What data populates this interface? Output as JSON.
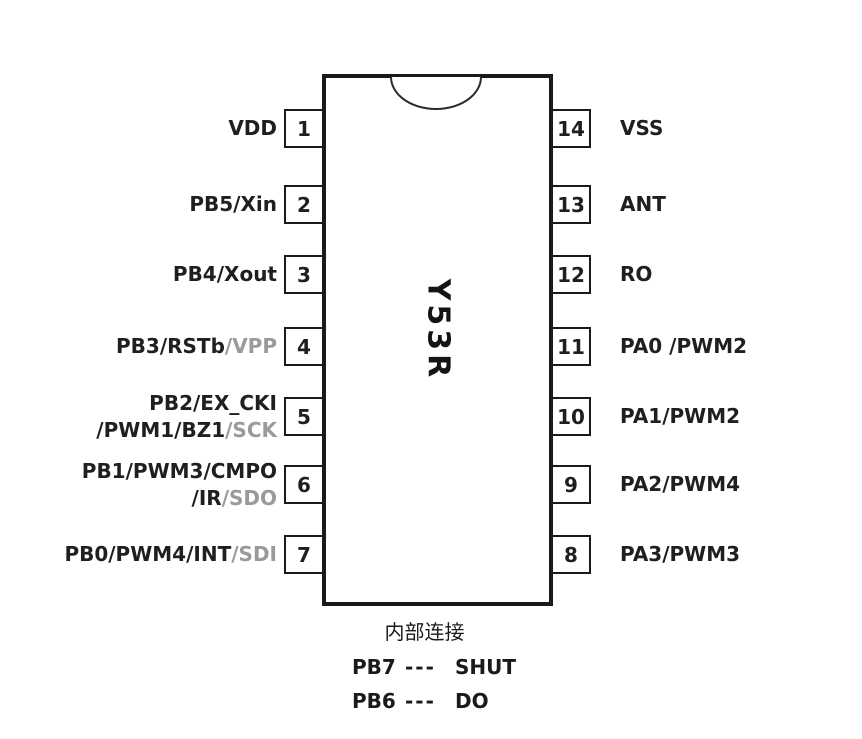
{
  "diagram": {
    "chip_name": "Y53R",
    "left_pins": [
      {
        "number": "1",
        "lines": [
          [
            {
              "text": "VDD",
              "gray": false
            }
          ]
        ]
      },
      {
        "number": "2",
        "lines": [
          [
            {
              "text": "PB5/Xin",
              "gray": false
            }
          ]
        ]
      },
      {
        "number": "3",
        "lines": [
          [
            {
              "text": "PB4/Xout",
              "gray": false
            }
          ]
        ]
      },
      {
        "number": "4",
        "lines": [
          [
            {
              "text": "PB3/RSTb",
              "gray": false
            },
            {
              "text": "/VPP",
              "gray": true
            }
          ]
        ]
      },
      {
        "number": "5",
        "lines": [
          [
            {
              "text": "PB2/EX_CKI",
              "gray": false
            }
          ],
          [
            {
              "text": "/PWM1/BZ1",
              "gray": false
            },
            {
              "text": "/SCK",
              "gray": true
            }
          ]
        ]
      },
      {
        "number": "6",
        "lines": [
          [
            {
              "text": "PB1/PWM3/CMPO",
              "gray": false
            }
          ],
          [
            {
              "text": "/IR",
              "gray": false
            },
            {
              "text": "/SDO",
              "gray": true
            }
          ]
        ]
      },
      {
        "number": "7",
        "lines": [
          [
            {
              "text": "PB0/PWM4/INT",
              "gray": false
            },
            {
              "text": "/SDI",
              "gray": true
            }
          ]
        ]
      }
    ],
    "right_pins": [
      {
        "number": "14",
        "lines": [
          [
            {
              "text": "VSS",
              "gray": false
            }
          ]
        ]
      },
      {
        "number": "13",
        "lines": [
          [
            {
              "text": "ANT",
              "gray": false
            }
          ]
        ]
      },
      {
        "number": "12",
        "lines": [
          [
            {
              "text": "RO",
              "gray": false
            }
          ]
        ]
      },
      {
        "number": "11",
        "lines": [
          [
            {
              "text": "PA0 /PWM2",
              "gray": false
            }
          ]
        ]
      },
      {
        "number": "10",
        "lines": [
          [
            {
              "text": "PA1/PWM2",
              "gray": false
            }
          ]
        ]
      },
      {
        "number": "9",
        "lines": [
          [
            {
              "text": "PA2/PWM4",
              "gray": false
            }
          ]
        ]
      },
      {
        "number": "8",
        "lines": [
          [
            {
              "text": "PA3/PWM3",
              "gray": false
            }
          ]
        ]
      }
    ],
    "footer": {
      "title": "内部连接",
      "rows": [
        {
          "pin": "PB7",
          "dash": "---",
          "signal": "SHUT"
        },
        {
          "pin": "PB6",
          "dash": "---",
          "signal": "DO"
        }
      ]
    },
    "colors": {
      "text": "#1f1f1f",
      "gray_text": "#9a9a9a",
      "line": "#1a1a1a"
    }
  }
}
